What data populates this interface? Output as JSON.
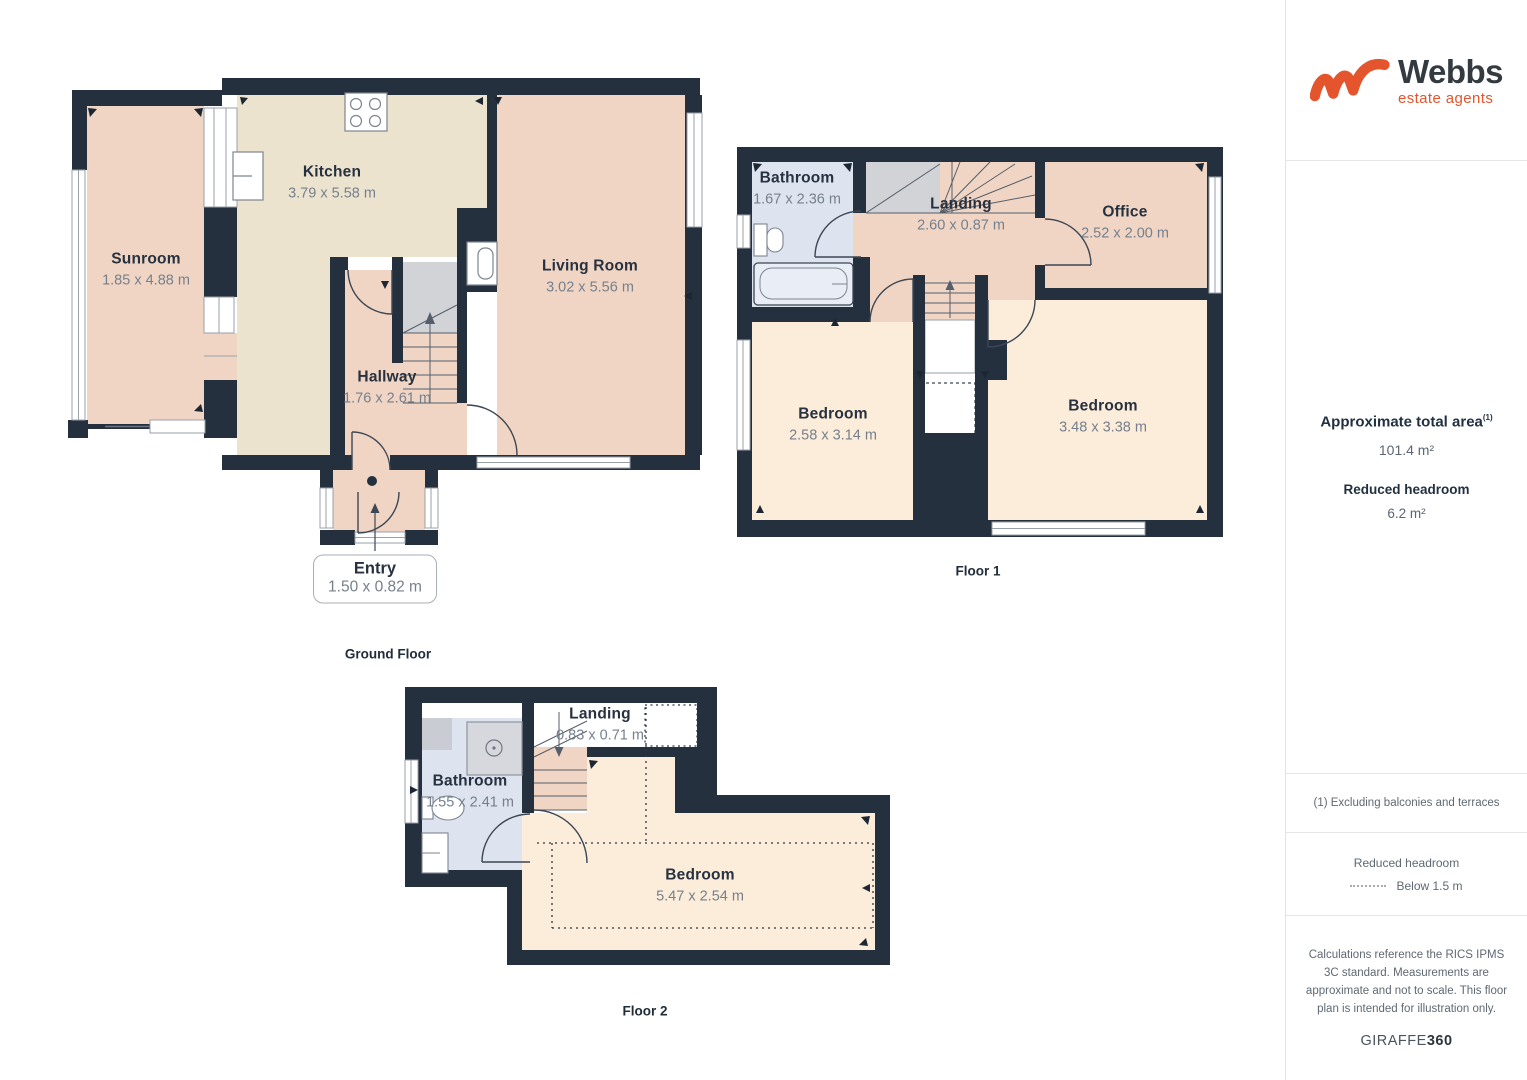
{
  "branding": {
    "logo_text": "Webbs",
    "logo_tagline": "estate agents"
  },
  "sidebar": {
    "area_title": "Approximate total area",
    "area_footnote_marker": "(1)",
    "area_value": "101.4 m²",
    "headroom_title": "Reduced headroom",
    "headroom_value": "6.2 m²",
    "footnote": "(1) Excluding balconies and terraces",
    "legend_title": "Reduced headroom",
    "legend_value": "Below 1.5 m",
    "disclaimer": "Calculations reference the RICS IPMS 3C standard. Measurements are approximate and not to scale. This floor plan is intended for illustration only.",
    "footer_brand": "GIRAFFE",
    "footer_brand_bold": "360"
  },
  "floors": {
    "ground": {
      "label": "Ground Floor",
      "rooms": {
        "sunroom": {
          "name": "Sunroom",
          "dims": "1.85 x 4.88 m"
        },
        "kitchen": {
          "name": "Kitchen",
          "dims": "3.79 x 5.58 m"
        },
        "living_room": {
          "name": "Living Room",
          "dims": "3.02 x 5.56 m"
        },
        "hallway": {
          "name": "Hallway",
          "dims": "1.76 x 2.61 m"
        },
        "entry": {
          "name": "Entry",
          "dims": "1.50 x 0.82 m"
        }
      }
    },
    "floor1": {
      "label": "Floor 1",
      "rooms": {
        "bathroom": {
          "name": "Bathroom",
          "dims": "1.67 x 2.36 m"
        },
        "landing": {
          "name": "Landing",
          "dims": "2.60 x 0.87 m"
        },
        "office": {
          "name": "Office",
          "dims": "2.52 x 2.00 m"
        },
        "bedroom_left": {
          "name": "Bedroom",
          "dims": "2.58 x 3.14 m"
        },
        "bedroom_right": {
          "name": "Bedroom",
          "dims": "3.48 x 3.38 m"
        }
      }
    },
    "floor2": {
      "label": "Floor 2",
      "rooms": {
        "bathroom": {
          "name": "Bathroom",
          "dims": "1.55 x 2.41 m"
        },
        "landing": {
          "name": "Landing",
          "dims": "0.83 x 0.71 m"
        },
        "bedroom": {
          "name": "Bedroom",
          "dims": "5.47 x 2.54 m"
        }
      }
    }
  },
  "colors": {
    "accent": "#e4552e",
    "wall": "#25303e",
    "room_pink": "#f0d5c4",
    "room_cream": "#ece3cf",
    "room_peach": "#fcecda",
    "room_blue": "#dde3ef",
    "stair_gray": "#d2d3d7"
  }
}
